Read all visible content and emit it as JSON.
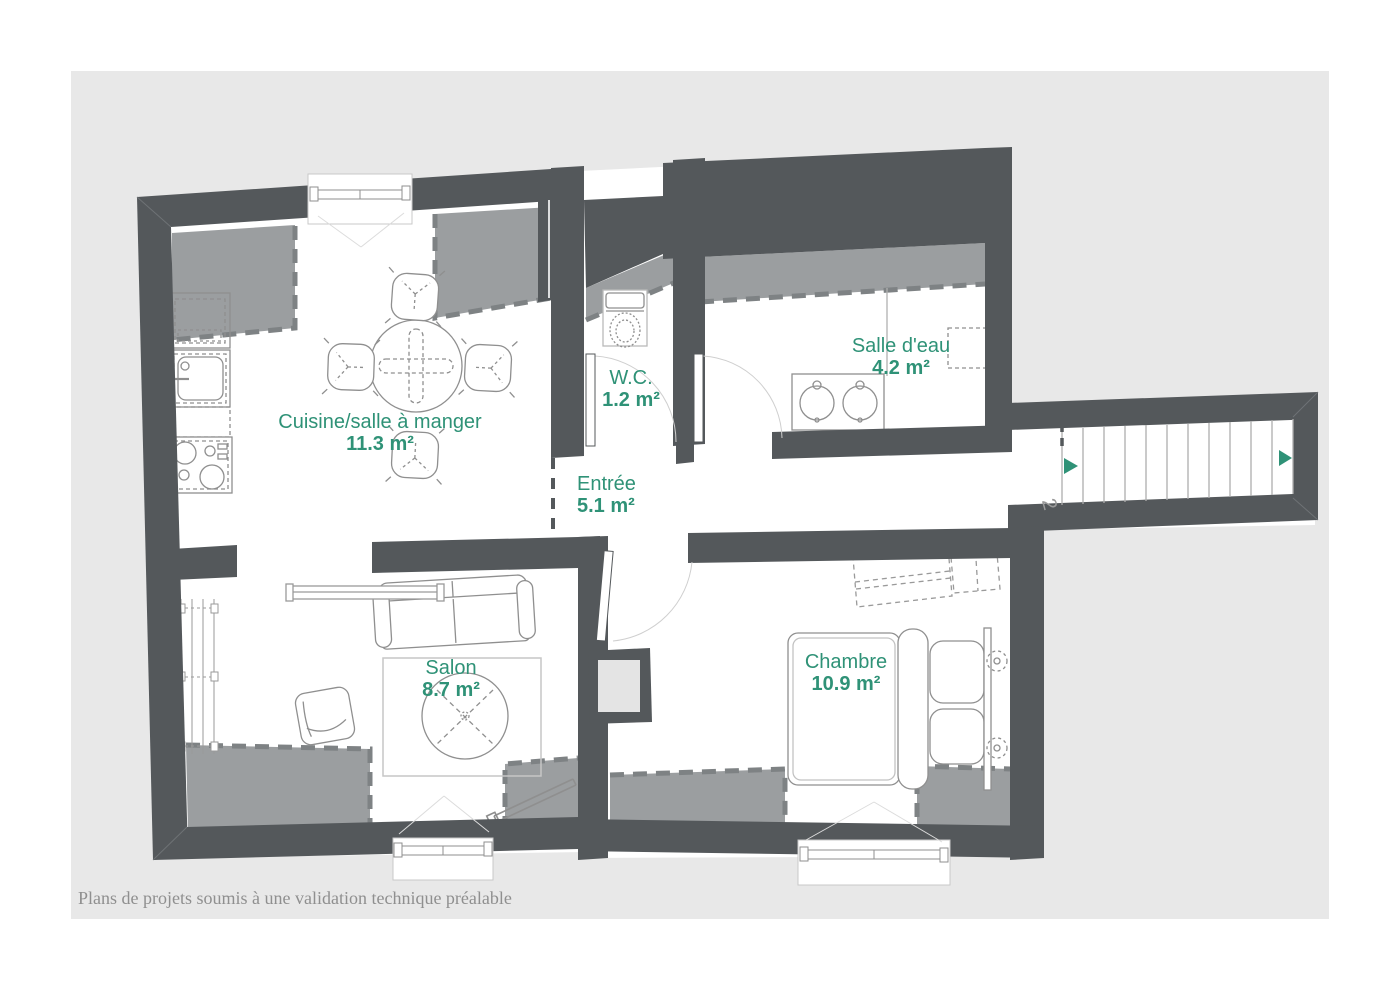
{
  "palette": {
    "canvas_background": "#e8e8e8",
    "wall": "#54585b",
    "low_ceiling_zone": "#9b9ea0",
    "accent_green": "#2f9277",
    "furniture_line": "#8f8f8f",
    "caption_gray": "#8f8f8f"
  },
  "rooms": [
    {
      "id": "cuisine",
      "name": "Cuisine/salle à manger",
      "area": "11.3 m²"
    },
    {
      "id": "wc",
      "name": "W.C.",
      "area": "1.2 m²"
    },
    {
      "id": "salle-deau",
      "name": "Salle d'eau",
      "area": "4.2 m²"
    },
    {
      "id": "entree",
      "name": "Entrée",
      "area": "5.1 m²"
    },
    {
      "id": "salon",
      "name": "Salon",
      "area": "8.7 m²"
    },
    {
      "id": "chambre",
      "name": "Chambre",
      "area": "10.9 m²"
    }
  ],
  "stairs": {
    "floor_label": "2"
  },
  "caption": {
    "text": "Plans de projets soumis à une validation technique préalable"
  }
}
